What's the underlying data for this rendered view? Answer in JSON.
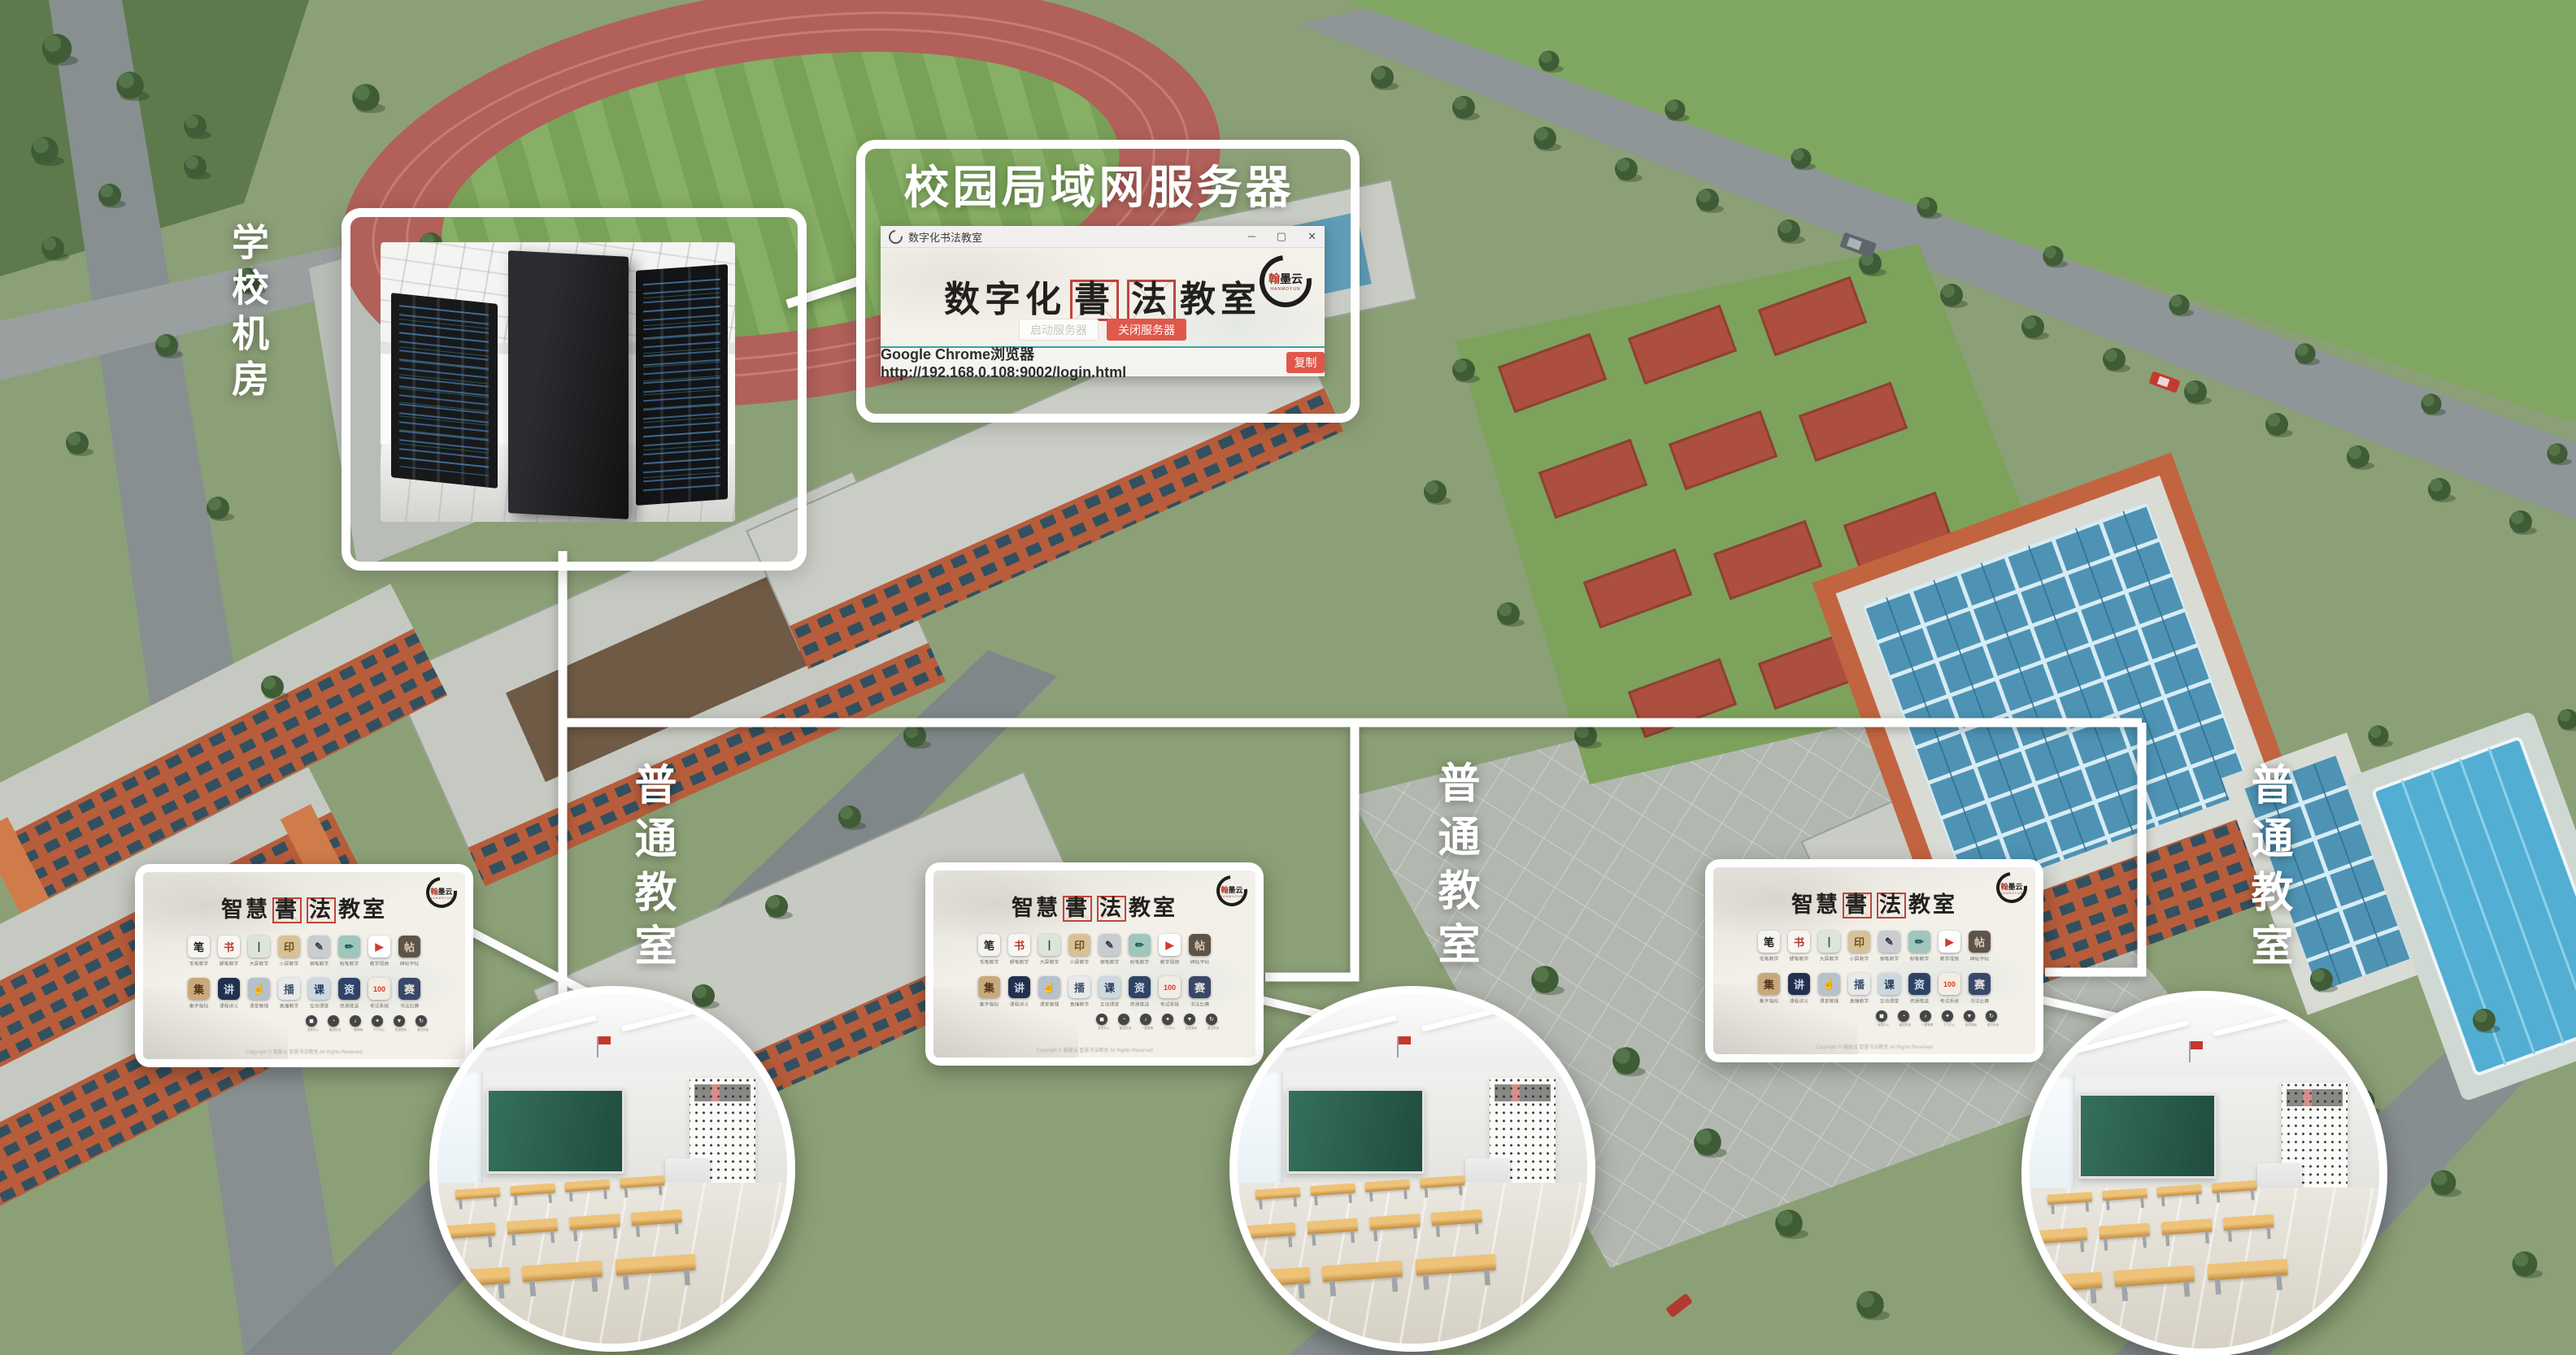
{
  "labels": {
    "server_room": "学校机房",
    "lan_server_title": "校园局域网服务器",
    "classroom": "普通教室"
  },
  "brand": {
    "logo_text": "翰墨云",
    "logo_sub": "HANMOYUN"
  },
  "browser": {
    "titlebar_title": "数字化书法教室",
    "controls": {
      "minimize": "─",
      "maximize": "▢",
      "close": "✕"
    },
    "main_title": {
      "prefix": "数字化",
      "boxed1": "書",
      "boxed2": "法",
      "suffix": "教室"
    },
    "start_button": "启动服务器",
    "stop_button": "关闭服务器",
    "browser_label": "Google Chrome浏览器",
    "url": "http://192.168.0.108:9002/login.html",
    "copy_button": "复制"
  },
  "screen": {
    "title": {
      "prefix": "智慧",
      "boxed1": "書",
      "boxed2": "法",
      "suffix": "教室"
    },
    "app_rows": [
      [
        {
          "label": "毛笔教学",
          "glyph": "笔",
          "bg": "#f5f4f0",
          "fg": "#1c1c1c"
        },
        {
          "label": "硬笔教学",
          "glyph": "书",
          "bg": "#f7f6f2",
          "fg": "#b5382e"
        },
        {
          "label": "大屏教学",
          "glyph": "丨",
          "bg": "#dde5d8",
          "fg": "#2f4a33"
        },
        {
          "label": "小屏教学",
          "glyph": "印",
          "bg": "#d9c196",
          "fg": "#6f4f1e"
        },
        {
          "label": "钢笔教学",
          "glyph": "✎",
          "bg": "#c9cdd1",
          "fg": "#33383c"
        },
        {
          "label": "粉笔教学",
          "glyph": "✏",
          "bg": "#9fc6bd",
          "fg": "#1f5e52"
        },
        {
          "label": "教学视频",
          "glyph": "▶",
          "bg": "#ffffff",
          "fg": "#d23b30"
        },
        {
          "label": "碑帖字帖",
          "glyph": "帖",
          "bg": "#5d5348",
          "fg": "#d8cdb8"
        }
      ],
      [
        {
          "label": "集字临帖",
          "glyph": "集",
          "bg": "#c9a97c",
          "fg": "#53351a"
        },
        {
          "label": "课程讲义",
          "glyph": "讲",
          "bg": "#22304f",
          "fg": "#cfd8ea"
        },
        {
          "label": "课堂管理",
          "glyph": "☝",
          "bg": "#b6c2cb",
          "fg": "#b8402f"
        },
        {
          "label": "直播教学",
          "glyph": "播",
          "bg": "#e7e9ea",
          "fg": "#44546a"
        },
        {
          "label": "互动课堂",
          "glyph": "课",
          "bg": "#cdd8e0",
          "fg": "#243a55"
        },
        {
          "label": "资源推送",
          "glyph": "资",
          "bg": "#2e4366",
          "fg": "#d8e0ea"
        },
        {
          "label": "考试系统",
          "glyph": "100",
          "bg": "#f2ece2",
          "fg": "#d23b30"
        },
        {
          "label": "书法比赛",
          "glyph": "赛",
          "bg": "#38476a",
          "fg": "#e8e4da"
        }
      ]
    ],
    "system_icons": [
      {
        "glyph": "◼",
        "label": "消息中心"
      },
      {
        "glyph": "◔",
        "label": "触控校准"
      },
      {
        "glyph": "♪",
        "label": "一键清屏"
      },
      {
        "glyph": "✦",
        "label": "个人中心"
      },
      {
        "glyph": "▼",
        "label": "检查更新"
      },
      {
        "glyph": "↻",
        "label": "退出系统"
      }
    ],
    "copyright": "Copyright © 翰墨云 智慧书法教室 All Rights Reserved"
  },
  "colors": {
    "accent_red": "#e0574b",
    "grid_box_red": "#c1443a",
    "divider_teal": "#36a3a3",
    "line_white": "#ffffff"
  }
}
